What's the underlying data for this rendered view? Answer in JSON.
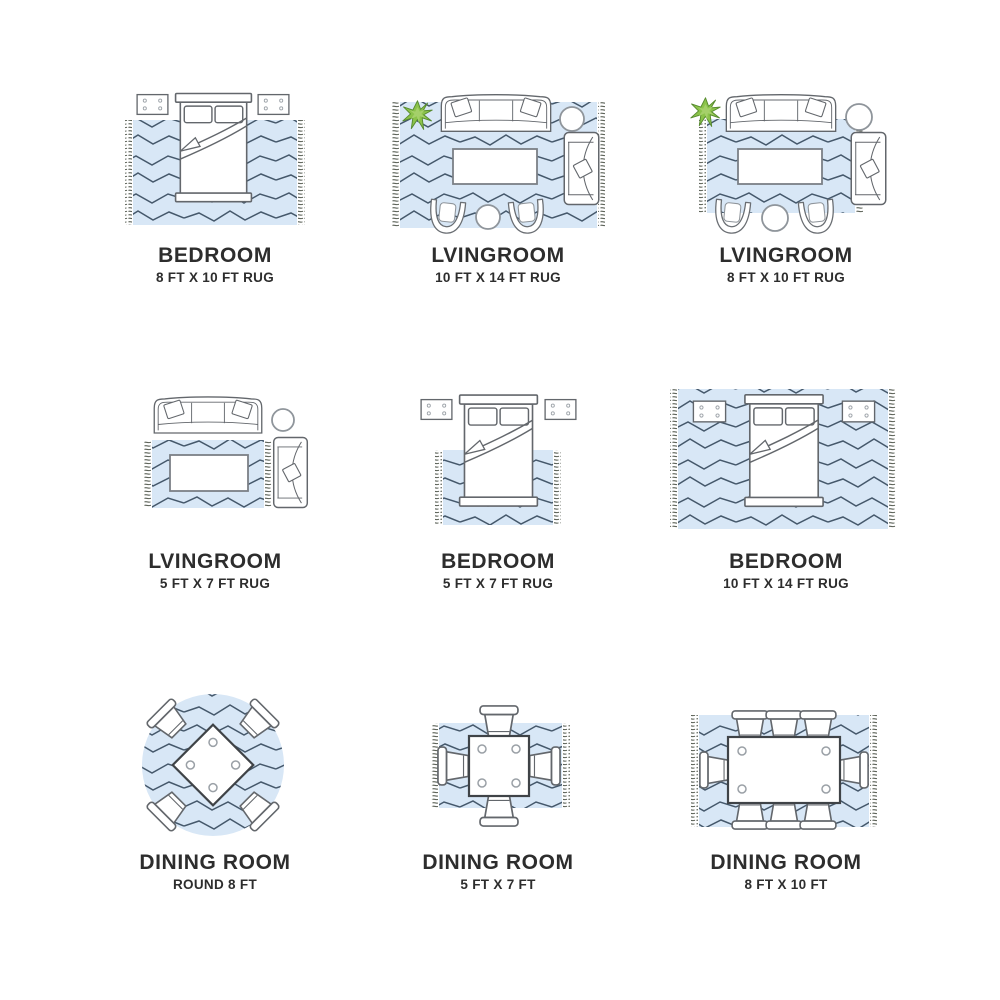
{
  "page": {
    "title": "Rug size placement guide",
    "background": "#ffffff"
  },
  "colors": {
    "rug_fill": "#d8e7f6",
    "rug_pattern_line": "#45586b",
    "rug_fringe": "#5c6258",
    "furniture_outline": "#63676c",
    "dining_table_outline": "#3f4347",
    "plant_green": "#8bc34a",
    "plant_green_light": "#a5d06a",
    "label_text": "#2d2d2d"
  },
  "panels": [
    {
      "id": "bedroom-8x10",
      "room": "BEDROOM",
      "size": "8 FT X 10 FT RUG",
      "rug_shape": "rectangle",
      "furniture": [
        "bed",
        "nightstand",
        "nightstand"
      ]
    },
    {
      "id": "livingroom-10x14",
      "room": "LVINGROOM",
      "size": "10 FT X 14 FT RUG",
      "rug_shape": "rectangle",
      "furniture": [
        "sofa",
        "plant",
        "side-table",
        "coffee-table",
        "armchair",
        "barrel-chair",
        "barrel-chair",
        "ottoman"
      ]
    },
    {
      "id": "livingroom-8x10",
      "room": "LVINGROOM",
      "size": "8 FT X 10 FT RUG",
      "rug_shape": "rectangle",
      "furniture": [
        "sofa",
        "plant",
        "side-table",
        "coffee-table",
        "armchair",
        "barrel-chair",
        "barrel-chair",
        "ottoman"
      ]
    },
    {
      "id": "livingroom-5x7",
      "room": "LVINGROOM",
      "size": "5 FT X 7 FT RUG",
      "rug_shape": "rectangle",
      "furniture": [
        "sofa",
        "side-table",
        "coffee-table",
        "armchair"
      ]
    },
    {
      "id": "bedroom-5x7",
      "room": "BEDROOM",
      "size": "5 FT X 7 FT RUG",
      "rug_shape": "rectangle",
      "furniture": [
        "bed",
        "nightstand",
        "nightstand"
      ]
    },
    {
      "id": "bedroom-10x14",
      "room": "BEDROOM",
      "size": "10 FT X 14 FT RUG",
      "rug_shape": "rectangle",
      "furniture": [
        "bed",
        "nightstand",
        "nightstand"
      ]
    },
    {
      "id": "dining-round-8",
      "room": "DINING ROOM",
      "size": "ROUND 8 FT",
      "rug_shape": "round",
      "furniture": [
        "dining-table",
        "dining-chair",
        "dining-chair",
        "dining-chair",
        "dining-chair"
      ]
    },
    {
      "id": "dining-5x7",
      "room": "DINING ROOM",
      "size": "5 FT X 7 FT",
      "rug_shape": "rectangle",
      "furniture": [
        "dining-table",
        "dining-chair",
        "dining-chair",
        "dining-chair",
        "dining-chair"
      ]
    },
    {
      "id": "dining-8x10",
      "room": "DINING ROOM",
      "size": "8 FT X 10 FT",
      "rug_shape": "rectangle",
      "furniture": [
        "dining-table",
        "dining-chair",
        "dining-chair",
        "dining-chair",
        "dining-chair",
        "dining-chair",
        "dining-chair",
        "dining-chair",
        "dining-chair"
      ]
    }
  ]
}
